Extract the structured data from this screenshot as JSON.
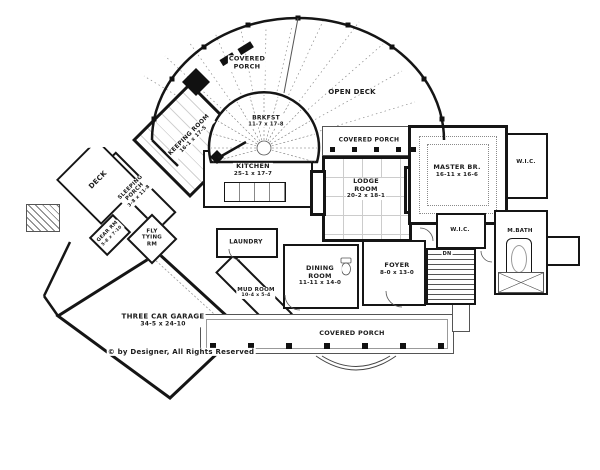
{
  "colors": {
    "wall": "#151515",
    "thin_line": "#555555",
    "dotted_line": "#999999",
    "background": "#ffffff"
  },
  "labels": {
    "covered_porch_top": {
      "line1": "COVERED",
      "line2": "PORCH"
    },
    "open_deck": {
      "text": "OPEN DECK"
    },
    "brkfst": {
      "name": "BRKFST",
      "dims": "11-7 x 17-8"
    },
    "covered_porch_right": {
      "text": "COVERED PORCH"
    },
    "kitchen": {
      "name": "KITCHEN",
      "dims": "25-1 x 17-7"
    },
    "lodge": {
      "line1": "LODGE",
      "line2": "ROOM",
      "dims": "20-2 x 18-1"
    },
    "master": {
      "name": "MASTER BR.",
      "dims": "16-11 x 16-6"
    },
    "wic_upper": {
      "text": "W.I.C."
    },
    "wic_lower": {
      "text": "W.I.C."
    },
    "mbath": {
      "text": "M.BATH"
    },
    "keeping": {
      "name": "KEEPING ROOM",
      "dims": "16-1 x 17-5"
    },
    "deck": {
      "text": "DECK"
    },
    "sleeping": {
      "line1": "SLEEPING",
      "line2": "PORCH",
      "dims": "3-8 x 11-8"
    },
    "gear": {
      "name": "GEAR RM",
      "dims": "5-8 x 7-10"
    },
    "fly": {
      "line1": "FLY",
      "line2": "TYING",
      "line3": "RM"
    },
    "laundry": {
      "text": "LAUNDRY"
    },
    "mud": {
      "name": "MUD ROOM",
      "dims": "10-4 x 5-4"
    },
    "dining": {
      "line1": "DINING",
      "line2": "ROOM",
      "dims": "11-11 x 14-0"
    },
    "foyer": {
      "name": "FOYER",
      "dims": "8-0 x 13-0"
    },
    "stairs": {
      "dn": "DN"
    },
    "garage": {
      "name": "THREE CAR GARAGE",
      "dims": "34-5 x 24-10"
    },
    "covered_porch_bottom": {
      "text": "COVERED PORCH"
    },
    "copyright": {
      "text": "© by Designer, All Rights Reserved"
    }
  }
}
